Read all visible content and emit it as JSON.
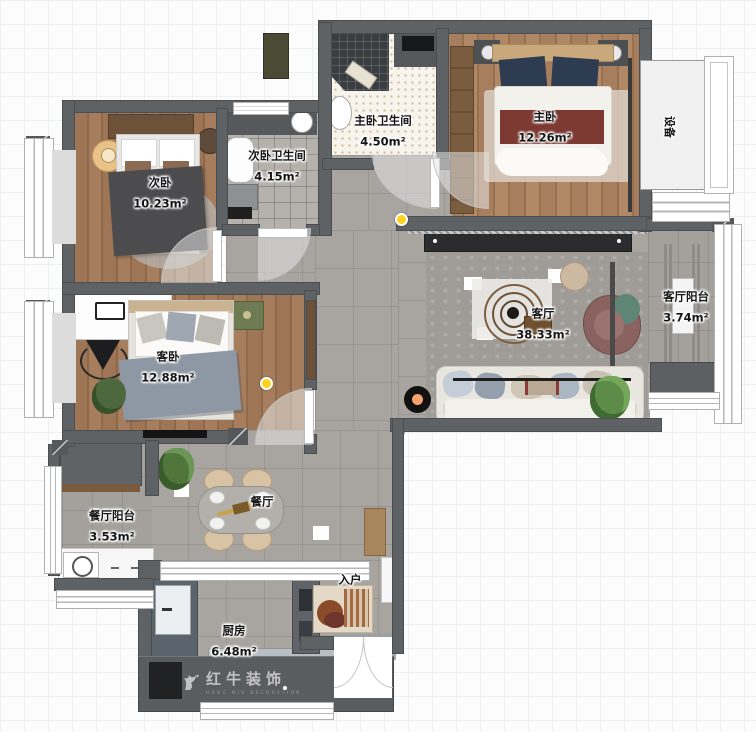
{
  "title": "apartment-floor-plan",
  "rooms": [
    {
      "id": "bedroom-2",
      "name": "次卧",
      "area": "10.23m²"
    },
    {
      "id": "bath-2",
      "name": "次卧卫生间",
      "area": "4.15m²"
    },
    {
      "id": "master-bath",
      "name": "主卧卫生间",
      "area": "4.50m²"
    },
    {
      "id": "master-bedroom",
      "name": "主卧",
      "area": "12.26m²"
    },
    {
      "id": "equipment-platform",
      "name": "设备",
      "area": ""
    },
    {
      "id": "living-room",
      "name": "客厅",
      "area": "38.33m²"
    },
    {
      "id": "living-balcony",
      "name": "客厅阳台",
      "area": "3.74m²"
    },
    {
      "id": "guest-bedroom",
      "name": "客卧",
      "area": "12.88m²"
    },
    {
      "id": "dining-balcony",
      "name": "餐厅阳台",
      "area": "3.53m²"
    },
    {
      "id": "dining-room",
      "name": "餐厅",
      "area": ""
    },
    {
      "id": "kitchen",
      "name": "厨房",
      "area": "6.48m²"
    },
    {
      "id": "entry",
      "name": "入户",
      "area": ""
    }
  ],
  "watermark": {
    "brand": "红牛装饰",
    "sub": "HONG NIU DECORATION"
  },
  "colors": {
    "wall": "#5e6265",
    "tile": "#a8a5a1",
    "wood": "#9e7655",
    "accent_marker": "#ffd21e",
    "bed_throw": "#7d3a32",
    "pillow_navy": "#2e3c52"
  }
}
